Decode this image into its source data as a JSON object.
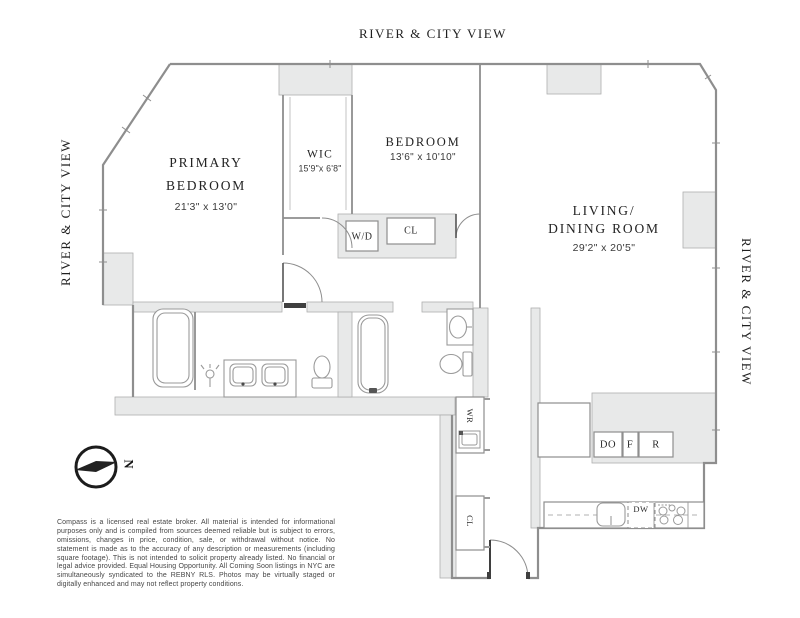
{
  "view_labels": {
    "top": "RIVER & CITY VIEW",
    "left": "RIVER & CITY VIEW",
    "right": "RIVER & CITY VIEW"
  },
  "rooms": {
    "primary_bedroom": {
      "line1": "PRIMARY",
      "line2": "BEDROOM",
      "dims": "21'3\" x 13'0\""
    },
    "wic": {
      "name": "WIC",
      "dims": "15'9\"x 6'8\""
    },
    "bedroom": {
      "name": "BEDROOM",
      "dims": "13'6\" x 10'10\""
    },
    "living_dining": {
      "line1": "LIVING/",
      "line2": "DINING ROOM",
      "dims": "29'2\" x 20'5\""
    }
  },
  "closets": {
    "washer_dryer": "W/D",
    "closet_top": "CL",
    "wine_ref": "WR",
    "closet_entry": "CL"
  },
  "appliances": {
    "double_oven": "DO",
    "freezer": "F",
    "refrigerator": "R",
    "dishwasher": "DW"
  },
  "compass": {
    "north": "N"
  },
  "disclaimer": "Compass is a licensed real estate broker. All material is intended for informational purposes only and is compiled from sources deemed reliable but is subject to errors, omissions, changes in price, condition, sale, or withdrawal without notice. No statement is made as to the accuracy of any description or measurements (including square footage). This is not intended to solicit property already listed. No financial or legal advice provided. Equal Housing Opportunity. All Coming Soon listings in NYC are simultaneously syndicated to the REBNY RLS. Photos may be virtually staged or digitally enhanced and may not reflect property conditions.",
  "colors": {
    "wall_fill": "#e8e9e9",
    "wall_line": "#8e8e8e",
    "dark": "#3f3f3f"
  }
}
